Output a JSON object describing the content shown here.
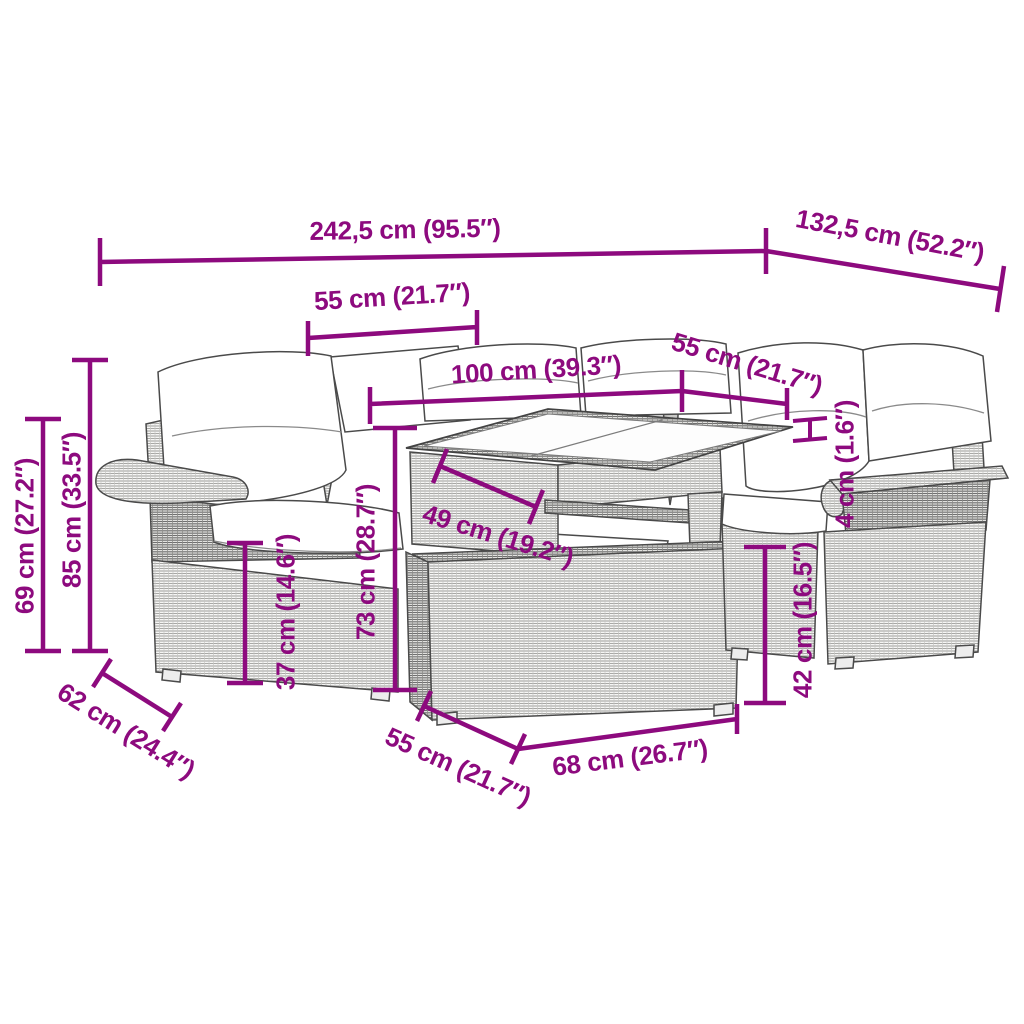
{
  "diagram": {
    "accent_color": "#8d0a7e",
    "dimensions": {
      "total_width": "242,5 cm (95.5″)",
      "total_depth": "132,5 cm (52.2″)",
      "left_backrest_width": "55 cm (21.7″)",
      "table_length": "100 cm (39.3″)",
      "right_backrest_width": "55 cm (21.7″)",
      "armrest_height": "69 cm (27.2″)",
      "total_height": "85 cm (33.5″)",
      "seat_depth": "62 cm (24.4″)",
      "seat_height": "37 cm (14.6″)",
      "table_height": "73 cm (28.7″)",
      "table_width": "49 cm (19.2″)",
      "glass_top_thickness": "4 cm (1.6″)",
      "ottoman_height": "42 cm (16.5″)",
      "ottoman_depth": "55 cm (21.7″)",
      "ottoman_width": "68 cm (26.7″)"
    }
  }
}
